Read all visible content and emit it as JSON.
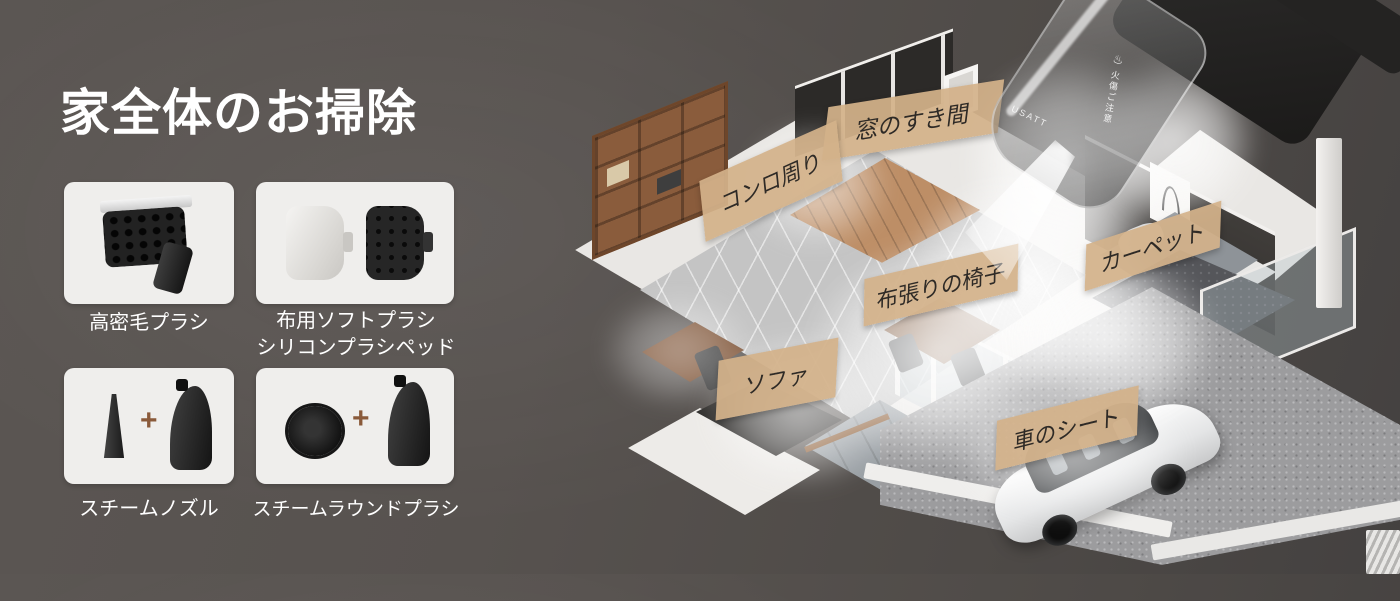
{
  "title": "家全体のお掃除",
  "accessories": [
    {
      "label": "高密毛プラシ"
    },
    {
      "label": "布用ソフトプラシ",
      "label2": "シリコンプラシペッド"
    },
    {
      "label": "スチームノズル",
      "plus": "+"
    },
    {
      "label": "スチームラウンドプラシ",
      "plus": "+"
    }
  ],
  "house_callouts": [
    {
      "text": "窓のすき間"
    },
    {
      "text": "コンロ周り"
    },
    {
      "text": "布張りの椅子"
    },
    {
      "text": "カーペット"
    },
    {
      "text": "ソファ"
    },
    {
      "text": "車のシート"
    }
  ],
  "device": {
    "brand": "USATT",
    "warning": "火傷ご注意",
    "caution_icon": "♨"
  },
  "colors": {
    "background": "#56514e",
    "card_background": "#efeeec",
    "callout_background": "#d3b28a",
    "callout_text": "#2e2a26",
    "plus_sign": "#8a5a3a",
    "title_text": "#ffffff"
  }
}
